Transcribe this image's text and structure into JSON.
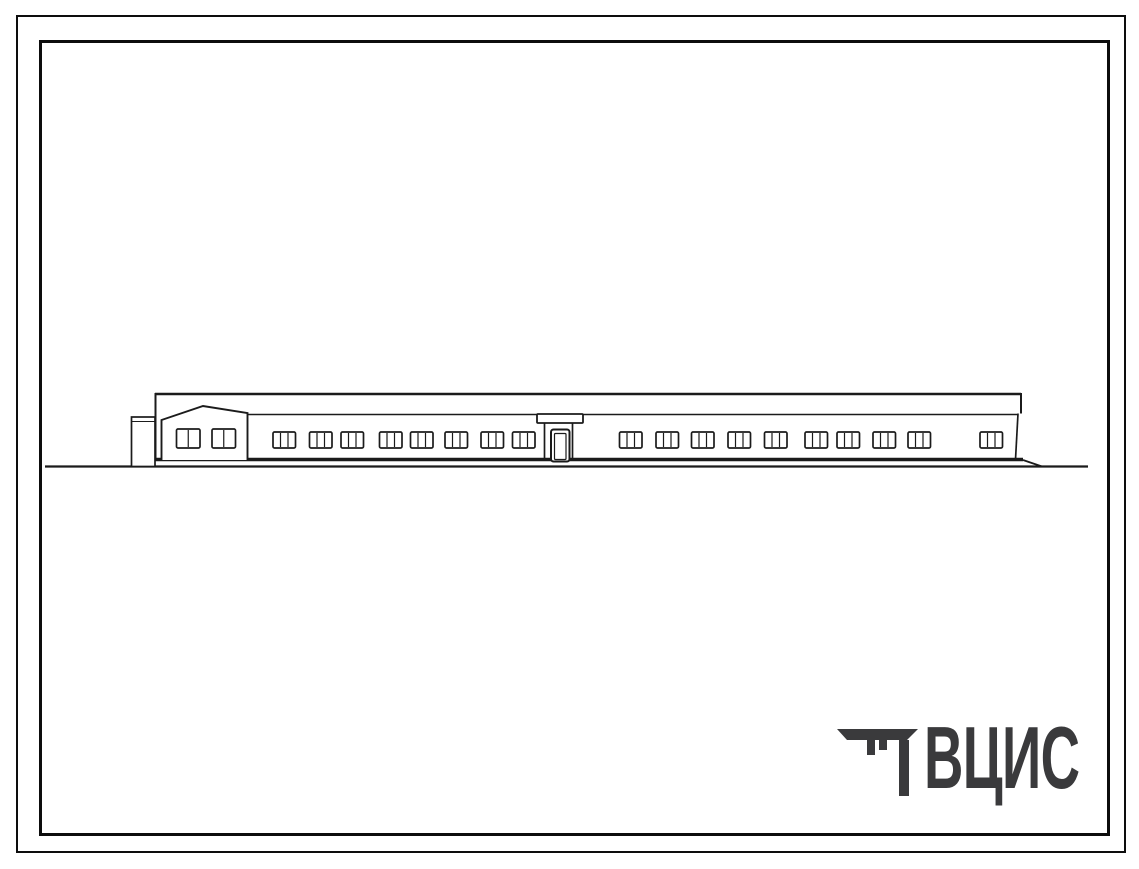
{
  "colors": {
    "ink": "#1b1b1b",
    "frame": "#0d0d0d",
    "logo": "#3a3a3c",
    "paper": "#ffffff"
  },
  "logo": {
    "text": "ВЦИС",
    "icon": "vcis-construction-emblem"
  },
  "drawing": {
    "title": "single-story-building-front-elevation",
    "ground_line": {
      "x1": 45,
      "x2": 1088,
      "y": 466.5,
      "w": 2.2
    },
    "building_base": {
      "x1": 152,
      "x2": 1023,
      "y": 459.5,
      "w": 3.4
    },
    "base_tail_right": {
      "x1": 1023,
      "y1": 460,
      "x2": 1042,
      "y2": 466.5
    },
    "base_tail_left": {
      "x1": 155,
      "y1": 460.5,
      "x2": 144,
      "y2": 466.5
    },
    "parapet_top": {
      "x1": 155,
      "x2": 1021,
      "y": 394
    },
    "wall_top": {
      "x1": 248,
      "x2": 1018,
      "y": 414.5
    },
    "edges": {
      "left_x": 155.5,
      "left_y1": 393,
      "left_y2": 460,
      "right_band_x": 1021,
      "right_band_y1": 393,
      "right_band_y2": 413.5,
      "right_wall": {
        "x1": 1018,
        "y1": 413.5,
        "x2": 1015.5,
        "y2": 459.5
      }
    },
    "annex": {
      "x": 131.5,
      "y": 417,
      "w": 23.5,
      "h": 49.5,
      "roof_line_y": 421.5
    },
    "gable": {
      "left": 161.5,
      "right": 247.5,
      "ridge_x": 203,
      "ridge_y": 406,
      "eave_left_y": 420,
      "eave_right_y": 413,
      "base_y": 460
    },
    "gable_windows": {
      "y": 429,
      "w": 23.5,
      "h": 19,
      "panes": 2,
      "x_starts": [
        176.5,
        212
      ]
    },
    "entrance": {
      "canopy": {
        "x": 537,
        "y": 414,
        "w": 46,
        "h": 9
      },
      "jamb_xs": [
        544.5,
        572.5
      ],
      "jamb_y1": 423,
      "jamb_y2": 459.5,
      "door": {
        "x": 551,
        "y": 429.5,
        "w": 18.5,
        "h": 30
      },
      "door_inner": {
        "x": 554.5,
        "y": 433.5,
        "w": 11.5,
        "h": 26
      }
    },
    "windows": {
      "y": 432,
      "w": 22.5,
      "h": 16,
      "panes": 3,
      "x_starts": [
        273,
        309.5,
        341,
        379.5,
        410.5,
        445,
        481,
        512.5,
        619.5,
        656,
        691.5,
        728,
        764.5,
        805,
        837,
        873,
        908,
        980
      ]
    }
  }
}
